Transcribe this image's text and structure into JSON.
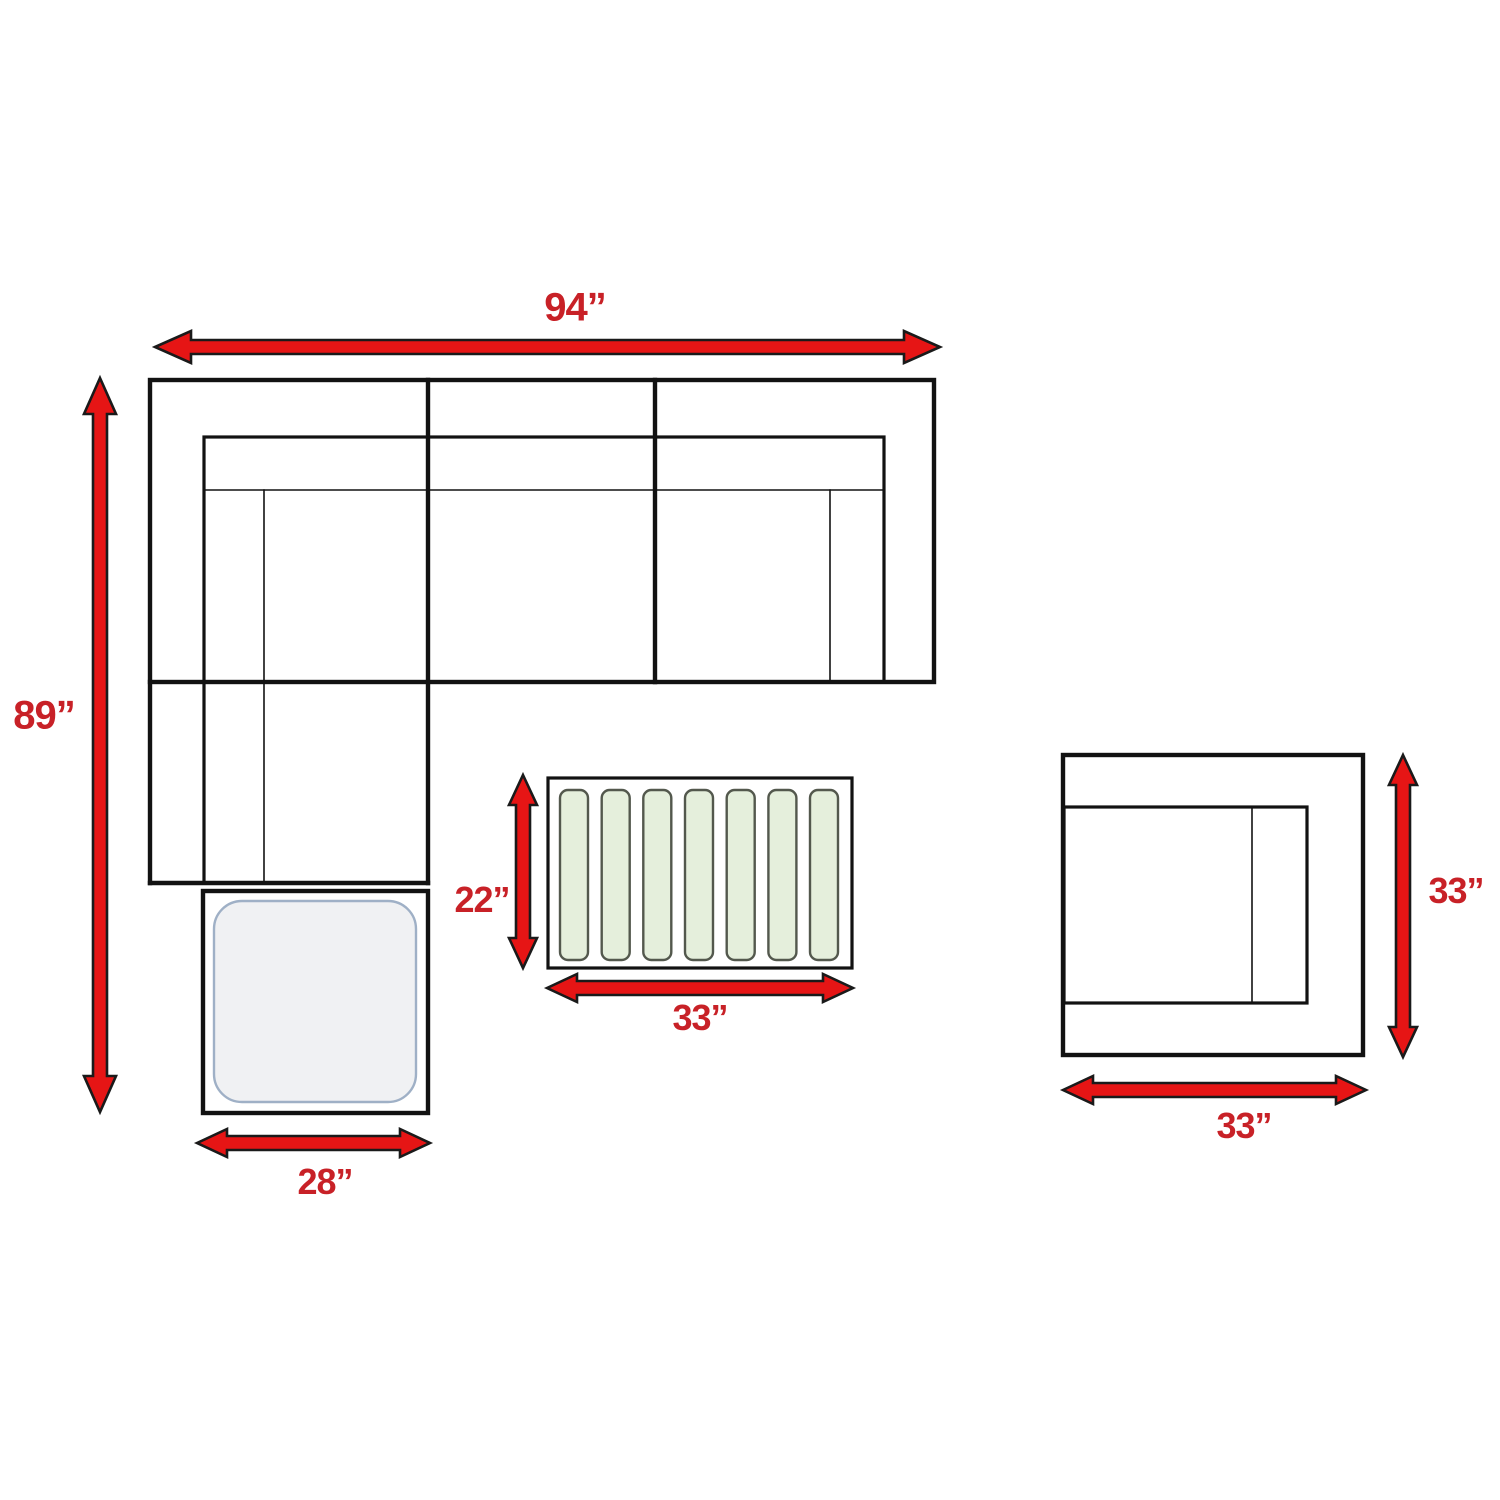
{
  "colors": {
    "background": "#ffffff",
    "line": "#121212",
    "arrow_fill": "#e61515",
    "arrow_outline": "#1a1a1a",
    "label_red": "#c82127",
    "slat_fill": "#e5efdc",
    "slat_border": "#53584d",
    "ottoman_top_fill": "#f0f1f3",
    "ottoman_top_border": "#9fb0c6"
  },
  "coffee_table": {
    "slat_count": 7
  },
  "dimensions": {
    "sofa_width": {
      "value": "94”"
    },
    "sectional_depth": {
      "value": "89”"
    },
    "coffee_table_depth": {
      "value": "22”"
    },
    "coffee_table_width": {
      "value": "33”"
    },
    "ottoman_width": {
      "value": "28”"
    },
    "chair_depth": {
      "value": "33”"
    },
    "chair_width": {
      "value": "33”"
    }
  }
}
